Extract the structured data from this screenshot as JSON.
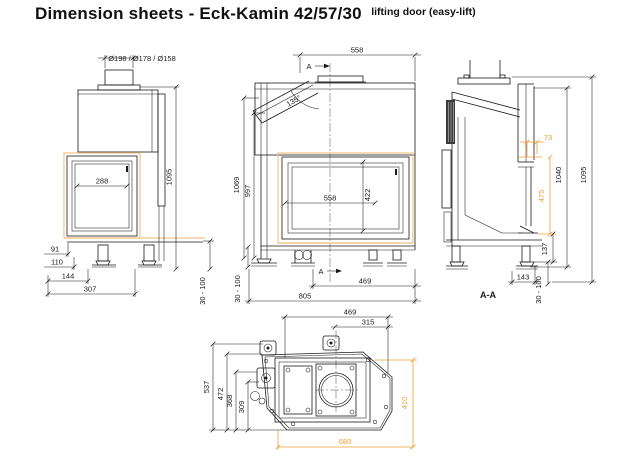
{
  "header": {
    "title": "Dimension sheets - Eck-Kamin 42/57/30",
    "subtitle": "lifting door (easy-lift)"
  },
  "colors": {
    "line": "#1a1a1a",
    "accent": "#ED9F35",
    "accent_light": "#F0C489"
  },
  "front_view": {
    "flue_diameters": "Ø198 / Ø178 / Ø158",
    "glass_width": "288",
    "total_height": "1095",
    "foot_range": "30 - 100",
    "dim_91": "91",
    "dim_110": "110",
    "dim_144": "144",
    "dim_307": "307"
  },
  "side_view": {
    "top_width": "558",
    "section_marker": "A",
    "flue_angle": "135°",
    "height_1069": "1069",
    "height_997": "997",
    "glass_width": "558",
    "glass_height": "422",
    "dim_469": "469",
    "dim_805": "805",
    "foot_range": "30 - 100"
  },
  "section_view": {
    "label": "A-A",
    "dim_73": "73",
    "dim_475": "475",
    "dim_1040": "1040",
    "dim_1095": "1095",
    "dim_137": "137",
    "dim_143": "143",
    "foot_range": "30 - 100"
  },
  "top_view": {
    "dim_469": "469",
    "dim_315": "315",
    "dim_537": "537",
    "dim_472": "472",
    "dim_368": "368",
    "dim_309": "309",
    "dim_410": "410",
    "dim_680": "680"
  }
}
